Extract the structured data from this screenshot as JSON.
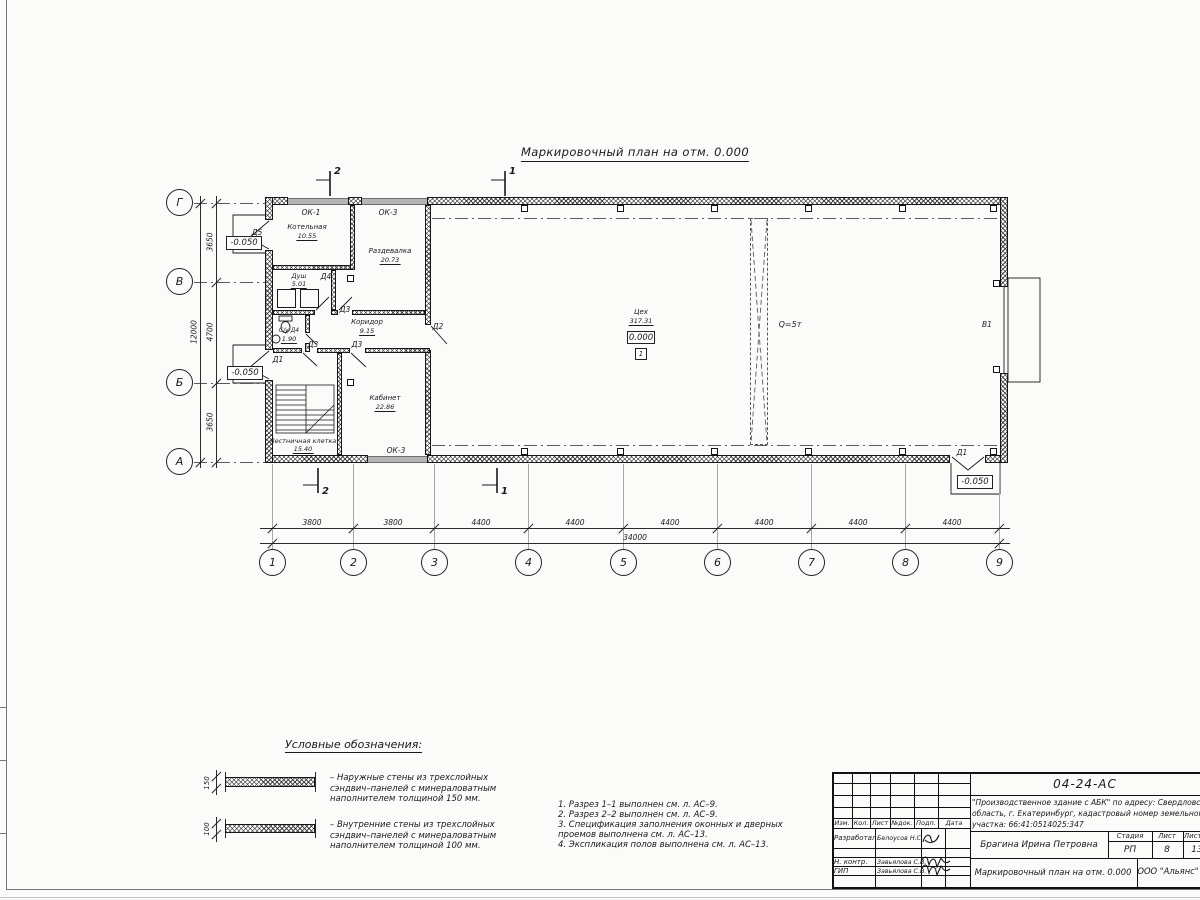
{
  "drawing": {
    "title": "Маркировочный план на отм. 0.000",
    "legend_title": "Условные обозначения:",
    "section1": "1",
    "section2": "2"
  },
  "plan": {
    "rooms": [
      {
        "name": "Котельная",
        "area": "10.55"
      },
      {
        "name": "Раздевалка",
        "area": "20.73"
      },
      {
        "name": "Душ",
        "area": "5.01"
      },
      {
        "name": "С/у Д4",
        "area": "1.90"
      },
      {
        "name": "Коридор",
        "area": "9.15"
      },
      {
        "name": "Кабинет",
        "area": "22.86"
      },
      {
        "name": "Лестничная клетка",
        "area": "15.40"
      },
      {
        "name": "Цех",
        "area": "317.31"
      }
    ],
    "workshop_elevation": "0.000",
    "workshop_floor_mark": "1",
    "crane_label": "Q=5т",
    "elevation_outside": "-0.050",
    "door_labels": {
      "d1": "Д1",
      "d2": "Д2",
      "d3": "Д3",
      "d4": "Д4",
      "d5": "Д5",
      "gate": "В1"
    },
    "window_labels": {
      "ok1": "ОК-1",
      "ok3": "ОК-3"
    }
  },
  "grid": {
    "cols": [
      "1",
      "2",
      "3",
      "4",
      "5",
      "6",
      "7",
      "8",
      "9"
    ],
    "rows": [
      "Г",
      "В",
      "Б",
      "А"
    ]
  },
  "dims": {
    "bottom": [
      "3800",
      "3800",
      "4400",
      "4400",
      "4400",
      "4400",
      "4400",
      "4400"
    ],
    "bottom_total": "34000",
    "left": [
      "3650",
      "4700",
      "3650"
    ],
    "left_total": "12000",
    "wall150": "150",
    "wall100": "100"
  },
  "legend": {
    "item1": "–  Наружные стены из трехслойных\nсэндвич–панелей с минераловатным\nнаполнителем толщиной 150 мм.",
    "item2": "–  Внутренние стены из трехслойных\nсэндвич–панелей с минераловатным\nнаполнителем толщиной 100 мм."
  },
  "notes": {
    "n1": "1.  Разрез 1–1 выполнен см. л. АС–9.",
    "n2": "2.  Разрез 2–2 выполнен см. л. АС–9.",
    "n3": "3.  Спецификация заполнения оконных и дверных\n      проемов выполнена см. л. АС–13.",
    "n4": "4.  Экспликация полов выполнена см. л. АС–13."
  },
  "titleblock": {
    "doc_number": "04-24-АС",
    "project": "\"Производственное здание с АБК\" по адресу: Свердловская\nобласть, г. Екатеринбург, кадастровый номер земельного\nучастка: 66:41:0514025:347",
    "col_headers": [
      "Изм.",
      "Кол.",
      "Лист",
      "№док.",
      "Подп.",
      "Дата"
    ],
    "row_developed_label": "Разработал",
    "row_developed_name": "Белоусов Н.С.",
    "row_ncontr_label": "Н. контр.",
    "row_ncontr_name": "Завьялова С.В.",
    "row_gip_label": "ГИП",
    "row_gip_name": "Завьялова С.В.",
    "author": "Брагина Ирина Петровна",
    "stage_label": "Стадия",
    "stage_value": "РП",
    "sheet_label": "Лист",
    "sheet_value": "8",
    "sheets_label": "Листов",
    "sheets_value": "13",
    "doc_title": "Маркировочный план на отм. 0.000",
    "company": "ООО \"Альянс\""
  }
}
